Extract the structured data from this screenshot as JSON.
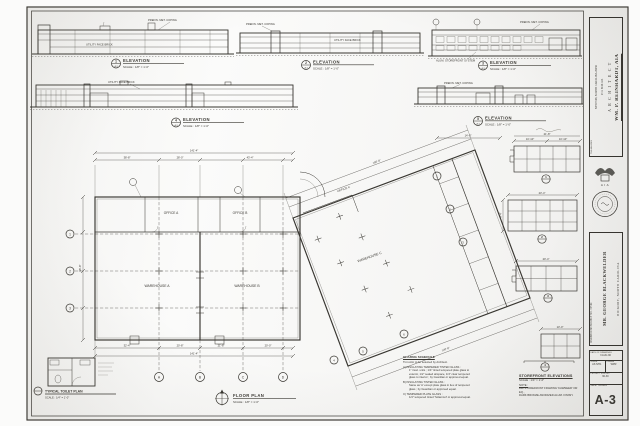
{
  "colors": {
    "paper": "#eae8e1",
    "ink": "#36342f",
    "pencil": "#97948c"
  },
  "title_block": {
    "architect_name": "WM. P. REINHARDT, AIA",
    "architect_title": "A R C H I T E C T",
    "address_line1": "P. O. BOX 443",
    "address_line2": "NEWTON, NORTH CAROLINA 28658",
    "phone": "704-464-2061",
    "member_label": "A I A",
    "project_line1": "WAREHOUSE PROJECT NO. 3 FOR:",
    "project_line2": "MR. GEORGE BLACKWELDER",
    "project_line3": "HICKORY,  NORTH CAROLINA",
    "date_label": "DATE OF DRAWINGS",
    "date_value": "3 AUG 90",
    "scale_label": "SCALE",
    "scale_value": "AS NTD.",
    "drawn_label": "DRAWN",
    "drawn_value": "WPR",
    "file_label": "PROJECT FILE NO.",
    "file_value": "90-30",
    "sheet_label": "SHEET NUMBER",
    "sheet_number": "A-3"
  },
  "marker_sheet": "A-3",
  "elevations": [
    {
      "mark": "1",
      "title": "ELEVATION",
      "scale": "SCALE : 1/8\" = 1'-0\""
    },
    {
      "mark": "2",
      "title": "ELEVATION",
      "scale": "SCALE : 1/8\" = 1'-0\""
    },
    {
      "mark": "3",
      "title": "ELEVATION",
      "scale": "SCALE : 1/8\" = 1'-0\""
    },
    {
      "mark": "4",
      "title": "ELEVATION",
      "scale": "SCALE : 1/8\" = 1'-0\""
    },
    {
      "mark": "5",
      "title": "ELEVATION",
      "scale": "SCALE : 1/8\" = 1'-0\""
    }
  ],
  "notes": {
    "coping": "PREFIN. MET. COPING",
    "brick": "UTILITY FACE BRICK",
    "storefront_sys": "ALUM. STOREFRONT SYSTEM"
  },
  "plan": {
    "title": "FLOOR PLAN",
    "scale": "SCALE : 1/8\" = 1'-0\"",
    "office_a": "OFFICE A",
    "office_b": "OFFICE B",
    "office_c": "OFFICE C",
    "warehouse_a": "WAREHOUSE A",
    "warehouse_b": "WAREHOUSE B",
    "warehouse_c": "WAREHOUSE C",
    "grid_cols": [
      "A",
      "B",
      "C",
      "D"
    ],
    "grid_rows": [
      "1",
      "2",
      "3"
    ],
    "bays": [
      "1",
      "2",
      "3",
      "4",
      "5",
      "6"
    ],
    "dims": {
      "top_total": "141'-4\"",
      "top_a": "38'-8\"",
      "top_b": "28'-0\"",
      "top_c": "43'-4\"",
      "bot_a": "32'-4\"",
      "bot_b": "20'-8\"",
      "bot_c": "21'-8\"",
      "bot_d": "20'-0\"",
      "bot_total": "141'-4\"",
      "left_total": "96'-8\"",
      "diag_top": "180'-8\"",
      "diag_bot": "120'-8\"",
      "sf_left": "14'-0\""
    }
  },
  "toilet": {
    "title": "TYPICAL TOILET PLAN",
    "scale": "SCALE : 1/4\" = 1'-0\""
  },
  "storefront": {
    "title": "STOREFRONT ELEVATIONS",
    "scale": "SCALE : 1/4\" = 1'-0\"",
    "note_label": "NOTE :",
    "note_line1": "ALL STOREFRONT FRAMING 'KAWNEER' OR EQ.,",
    "note_line2": "DARK BRONZE ANODIZED ALUM. FINISH.",
    "grids": [
      {
        "no": "1",
        "dim_total": "21'-8\"",
        "dim_a": "10'-10\"",
        "dim_b": "10'-10\""
      },
      {
        "no": "2",
        "dim_total": "23'-4\"",
        "dim_side": "9'-4\""
      },
      {
        "no": "3",
        "dim_total": "20'-4\""
      },
      {
        "no": "4",
        "dim_total": "13'-0\""
      }
    ]
  },
  "glazing": {
    "lines": [
      "GLAZING SCHEDULE",
      "Tint color to be selected by Architect.",
      "A)  INSULATING TEMPERED TINTED GLASS :",
      "1\" insul. units ; 1/4\" tinted tempered plate glass to",
      "exterior, 1/2\" sealed airspace, 1/4\" clear tempered",
      "glass to interior ; by Guardian or approved equal.",
      "B)  INSULATING TINTED GLASS :",
      "Same as 'A' except plate glass in lieu of tempered",
      "glass ; by Guardian or approved equal.",
      "C)  TEMPERED PLATE GLASS :",
      "1/4\" tempered tinted 'Solarcool' or approved equal."
    ]
  }
}
